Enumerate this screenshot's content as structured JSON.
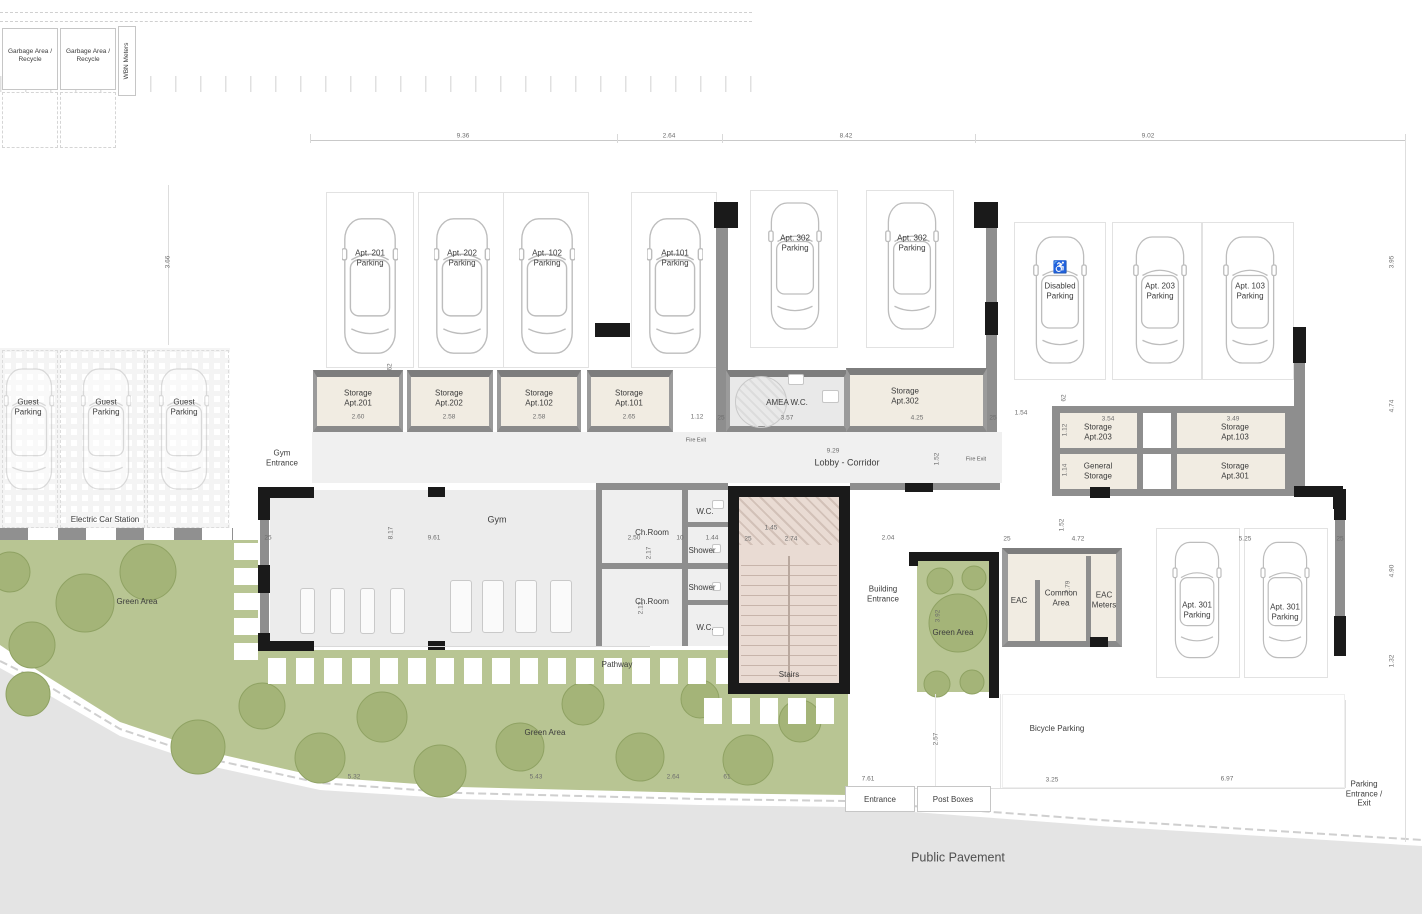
{
  "colors": {
    "green_area": "#b8c593",
    "tree": "#a4b478",
    "tree_stroke": "#8fa263",
    "wall_gray": "#8e8e8e",
    "column_black": "#1a1a1a",
    "storage_floor": "#f1ece2",
    "stairs_floor": "#e9dbd3",
    "pavement": "#e4e4e4",
    "gym_floor": "#ececec"
  },
  "top": {
    "garbage_left": "Garbage Area /\nRecycle",
    "garbage_right": "Garbage Area /\nRecycle",
    "wbn_meters": "WBN Meters"
  },
  "parking": {
    "upper": [
      "Apt. 201\nParking",
      "Apt. 202\nParking",
      "Apt. 102\nParking",
      "Apt.101\nParking"
    ],
    "apt302": [
      "Apt. 302\nParking",
      "Apt. 302\nParking"
    ],
    "right": [
      "Disabled\nParking",
      "Apt. 203\nParking",
      "Apt. 103\nParking"
    ],
    "disabled_icon": "♿",
    "guest": [
      "Guest\nParking",
      "Guest\nParking",
      "Guest\nParking"
    ],
    "apt301": [
      "Apt. 301\nParking",
      "Apt. 301\nParking"
    ],
    "electric_station": "Electric Car Station",
    "bicycle": "Bicycle Parking",
    "entrance_exit": "Parking Entrance /\nExit"
  },
  "rooms": {
    "storage201": {
      "label": "Storage\nApt.201",
      "size": "2.60"
    },
    "storage202": {
      "label": "Storage\nApt.202",
      "size": "2.58"
    },
    "storage102": {
      "label": "Storage\nApt.102",
      "size": "2.58"
    },
    "storage101": {
      "label": "Storage\nApt.101",
      "size": "2.65"
    },
    "amea_wc": {
      "label": "AMEA W.C.",
      "size": "3.57"
    },
    "storage302": {
      "label": "Storage\nApt.302",
      "size": "4.25"
    },
    "storage203": {
      "label": "Storage\nApt.203",
      "size": "3.54"
    },
    "storage103": {
      "label": "Storage\nApt.103",
      "size": "3.49"
    },
    "general_storage": {
      "label": "General\nStorage"
    },
    "storage301": {
      "label": "Storage\nApt.301"
    },
    "gym": "Gym",
    "gym_entrance": "Gym\nEntrance",
    "lobby": {
      "label": "Lobby - Corridor",
      "size": "9.29"
    },
    "wc_top": "W.C.",
    "chroom_top": "Ch.Room",
    "shower_top": "Shower",
    "shower_bottom": "Shower",
    "chroom_bottom": "Ch.Room",
    "wc_bottom": "W.C.",
    "stairs": "Stairs",
    "building_entrance": "Building\nEntrance",
    "eac": "EAC",
    "common_area": "Common\nArea",
    "eac_meters": "EAC\nMeters",
    "fire_exit_left": "Fire Exit",
    "fire_exit_right": "Fire Exit"
  },
  "site": {
    "green_area_left": "Green Area",
    "green_area_mid": "Green Area",
    "green_area_small": "Green Area",
    "pathway": "Pathway",
    "public_pavement": "Public Pavement",
    "entrance": "Entrance",
    "post_boxes": "Post Boxes"
  },
  "dims": [
    "9.36",
    "2.64",
    "8.42",
    "9.02",
    "3.66",
    "3.95",
    "4.74",
    "4.90",
    "1.32",
    "1.12",
    "25",
    "25",
    "1.52",
    "1.54",
    "62",
    "1.12",
    "1.14",
    "8.17",
    "9.61",
    "2.50",
    "1.44",
    "2.17",
    "2.12",
    "1.45",
    "25",
    "2.74",
    "2.04",
    "25",
    "4.72",
    "1.52",
    "2.79",
    "5.25",
    "25",
    "3.92",
    "2.57",
    "7.61",
    "5.32",
    "5.43",
    "2.64",
    "61",
    "3.25",
    "6.97",
    "62",
    "25",
    "10"
  ]
}
